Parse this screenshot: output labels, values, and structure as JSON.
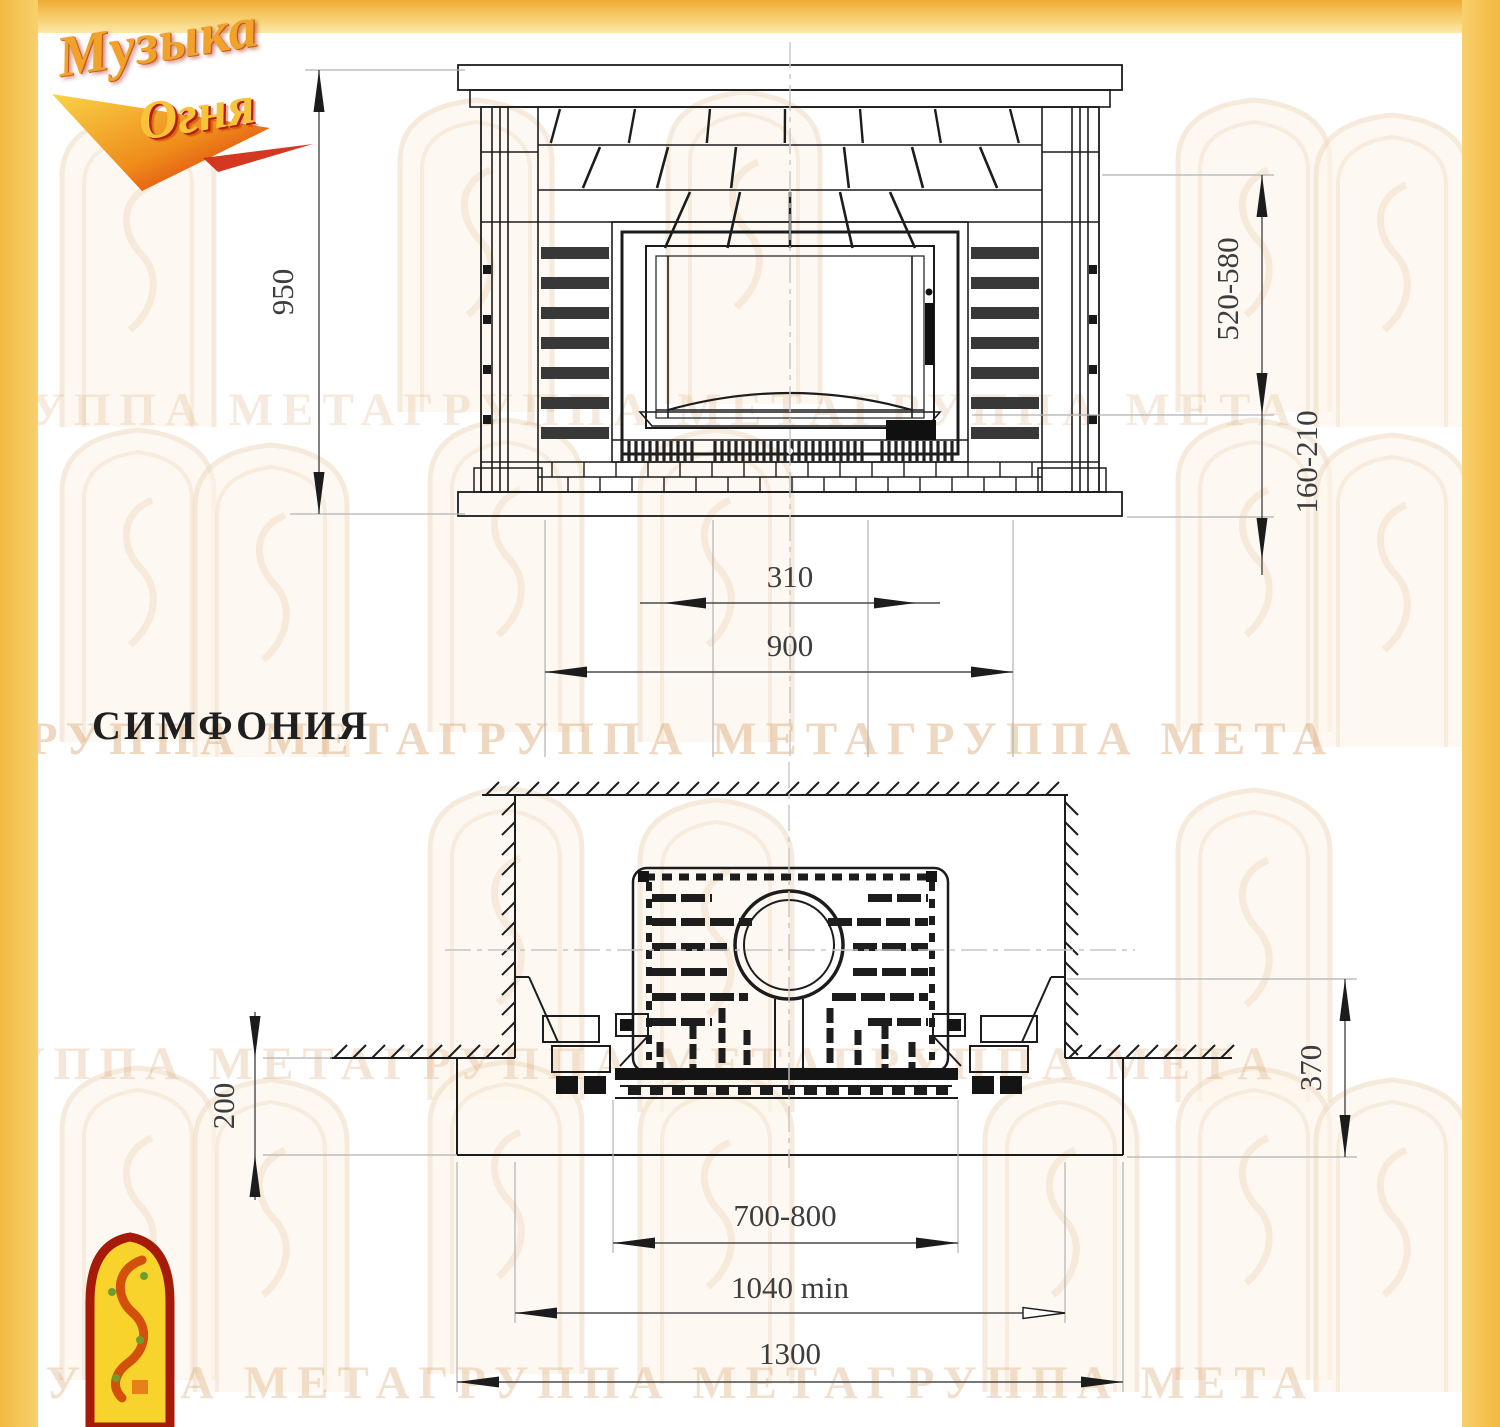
{
  "page": {
    "title_label": "СИМФОНИЯ"
  },
  "logo": {
    "line1": "Музыка",
    "line2": "Огня"
  },
  "watermark": {
    "text": "ГРУППА МЕТАГРУППА МЕТАГРУППА МЕТА"
  },
  "front_view": {
    "dims": {
      "overall_height": "950",
      "opening_height": "520-580",
      "hearth_height": "160-210",
      "grate_width": "310",
      "portal_width": "900"
    }
  },
  "plan_view": {
    "dims": {
      "hearth_projection": "200",
      "front_depth": "370",
      "opening_width": "700-800",
      "niche_width": "1040 min",
      "base_width": "1300"
    }
  }
}
